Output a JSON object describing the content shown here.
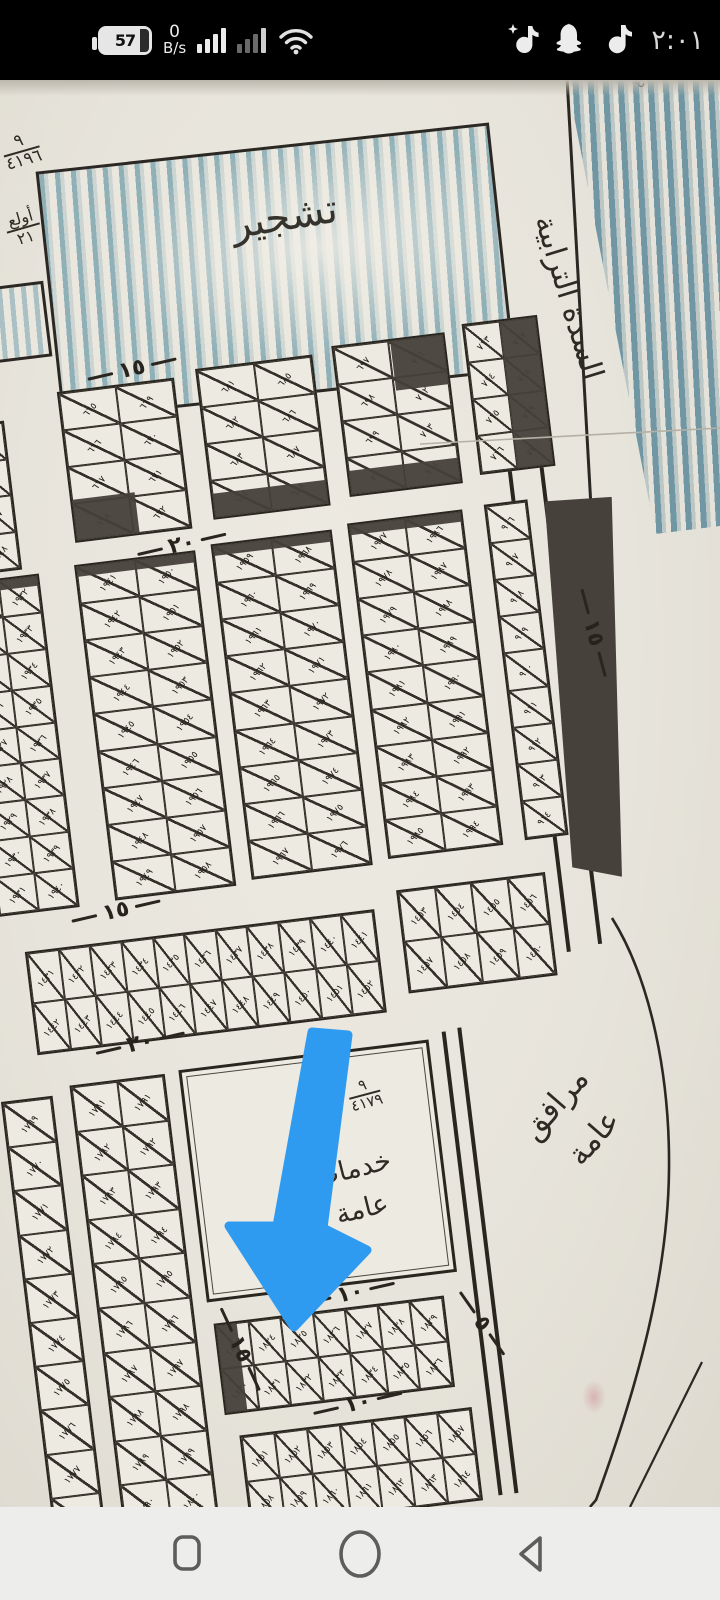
{
  "status_bar": {
    "battery_percent": "57",
    "net_speed_value": "0",
    "net_speed_unit": "B/s",
    "time": "٢:٠١",
    "right_icons": [
      "tiktok-lite",
      "snapchat",
      "tiktok"
    ],
    "colors": {
      "bg": "#000000",
      "fg": "#ececec",
      "dim": "#6a6a6a"
    }
  },
  "nav_bar": {
    "icons": [
      "recents",
      "home",
      "back"
    ],
    "bg": "#ededec",
    "icon_color": "#5d5d5d"
  },
  "map": {
    "description": "hand-drawn cadastral subdivision plan photo, tilted, with blue marker arrow annotation",
    "colors": {
      "paper": "#e7e4db",
      "ink": "#29261f",
      "dark_fill": "#46413a",
      "crayon_blue": "#377a94",
      "arrow_blue": "#2f9bf0"
    },
    "labels": {
      "afforestation": "تشجير",
      "street_name_right": "السدة الترابية",
      "services_l1": "خدمات",
      "services_l2": "عامة",
      "facilities_l1": "مرافق",
      "facilities_l2": "عامة",
      "frac_top_num": "٩",
      "frac_top_den": "٤١٩٦",
      "frac_services_num": "٩",
      "frac_services_den": "٤١٧٩",
      "note_m": "مـ",
      "dunam_r_top": "أولع",
      "dunam_r_bot": "٢١",
      "dunam_l_top": "دونم",
      "dunam_l_bot": "٦",
      "corner_scribble": "٤٤٢"
    },
    "street_labels": [
      {
        "text": "١٥",
        "x": 134,
        "y": 252,
        "rot": -6
      },
      {
        "text": "٢٠",
        "x": 162,
        "y": 432,
        "rot": -6
      },
      {
        "text": "١٥",
        "x": 52,
        "y": 788,
        "rot": -6
      },
      {
        "text": "٢٠",
        "x": 60,
        "y": 922,
        "rot": -6
      },
      {
        "text": "١٠",
        "x": 238,
        "y": 1196,
        "rot": -6
      },
      {
        "text": "٥",
        "x": 372,
        "y": 1242,
        "rot": 62
      },
      {
        "text": "١٠",
        "x": 232,
        "y": 1306,
        "rot": -6
      },
      {
        "text": "١٥",
        "x": 122,
        "y": 1238,
        "rot": 72
      },
      {
        "text": "١٥",
        "x": 560,
        "y": 570,
        "rot": 82
      }
    ],
    "blocks": [
      {
        "x": -22,
        "y": 300,
        "w": 74,
        "h": 150,
        "rows": 4,
        "cols": 2,
        "start": 641,
        "order": "col"
      },
      {
        "x": 108,
        "y": 278,
        "w": 118,
        "h": 152,
        "rows": 4,
        "cols": 2,
        "start": 665,
        "order": "col",
        "dark": [
          [
            0,
            72,
            55,
            28
          ]
        ]
      },
      {
        "x": 248,
        "y": 272,
        "w": 118,
        "h": 152,
        "rows": 4,
        "cols": 2,
        "start": 681,
        "order": "col",
        "dark": [
          [
            0,
            84,
            100,
            16
          ]
        ]
      },
      {
        "x": 386,
        "y": 266,
        "w": 114,
        "h": 152,
        "rows": 4,
        "cols": 2,
        "start": 697,
        "order": "col",
        "dark": [
          [
            52,
            0,
            48,
            34
          ],
          [
            0,
            84,
            100,
            16
          ]
        ]
      },
      {
        "x": 518,
        "y": 260,
        "w": 76,
        "h": 152,
        "rows": 4,
        "cols": 2,
        "start": 713,
        "order": "col",
        "dark": [
          [
            50,
            0,
            50,
            100
          ]
        ]
      },
      {
        "x": -14,
        "y": 456,
        "w": 82,
        "h": 336,
        "rows": 9,
        "cols": 2,
        "start": 1923,
        "order": "col",
        "dark": [
          [
            0,
            0,
            100,
            3
          ]
        ]
      },
      {
        "x": 104,
        "y": 452,
        "w": 122,
        "h": 338,
        "rows": 9,
        "cols": 2,
        "start": 1941,
        "order": "col",
        "dark": [
          [
            0,
            0,
            100,
            3
          ]
        ]
      },
      {
        "x": 242,
        "y": 448,
        "w": 122,
        "h": 338,
        "rows": 9,
        "cols": 2,
        "start": 1959,
        "order": "col",
        "dark": [
          [
            0,
            0,
            100,
            3
          ]
        ]
      },
      {
        "x": 380,
        "y": 444,
        "w": 116,
        "h": 338,
        "rows": 9,
        "cols": 2,
        "start": 1977,
        "order": "col",
        "dark": [
          [
            0,
            0,
            100,
            3
          ]
        ]
      },
      {
        "x": 518,
        "y": 442,
        "w": 44,
        "h": 338,
        "rows": 9,
        "cols": 1,
        "start": 906,
        "order": "col"
      },
      {
        "x": 8,
        "y": 830,
        "w": 352,
        "h": 104,
        "rows": 2,
        "cols": 11,
        "start": 1431,
        "order": "row"
      },
      {
        "x": 384,
        "y": 814,
        "w": 150,
        "h": 104,
        "rows": 2,
        "cols": 4,
        "start": 1453,
        "order": "row"
      },
      {
        "x": -34,
        "y": 976,
        "w": 52,
        "h": 446,
        "rows": 10,
        "cols": 1,
        "start": 1769,
        "order": "col"
      },
      {
        "x": 36,
        "y": 968,
        "w": 96,
        "h": 450,
        "rows": 10,
        "cols": 2,
        "start": 1781,
        "order": "col"
      },
      {
        "x": 150,
        "y": 1222,
        "w": 232,
        "h": 92,
        "rows": 2,
        "cols": 7,
        "start": 1823,
        "order": "row",
        "dark": [
          [
            0,
            0,
            9,
            100
          ]
        ]
      },
      {
        "x": 162,
        "y": 1336,
        "w": 234,
        "h": 94,
        "rows": 2,
        "cols": 7,
        "start": 1851,
        "order": "row"
      }
    ]
  }
}
